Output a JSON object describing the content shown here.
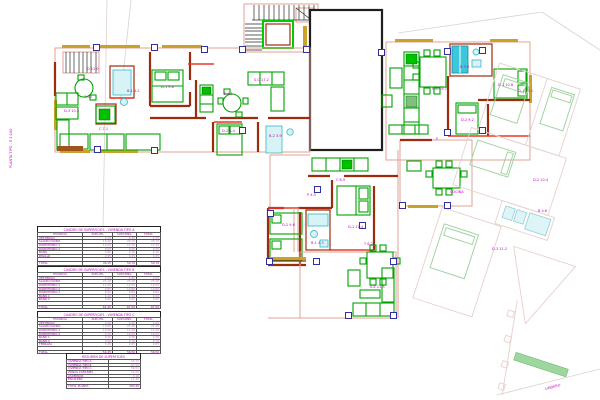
{
  "plan": {
    "side_note": "PLANTA TIPO - E 1:100",
    "boundary_note": "LINDERO",
    "labels": [
      [
        84,
        96,
        "3.60"
      ],
      [
        127,
        90,
        "B-1 4.2"
      ],
      [
        161,
        86,
        "D-1 9.8"
      ],
      [
        224,
        93,
        "E 4.1"
      ],
      [
        254,
        79,
        "S-C 17.2"
      ],
      [
        222,
        130,
        "D-2 8.4"
      ],
      [
        269,
        135,
        "B-2 3.9"
      ],
      [
        64,
        110,
        "D-3 10.2"
      ],
      [
        99,
        128,
        "C 7.1"
      ],
      [
        87,
        68,
        "D 11.0"
      ],
      [
        336,
        179,
        "C 8.9"
      ],
      [
        348,
        226,
        "D-1 11.4"
      ],
      [
        311,
        242,
        "B-1 4.3"
      ],
      [
        282,
        224,
        "D-2 9.6"
      ],
      [
        370,
        286,
        "S-E 21.3"
      ],
      [
        307,
        194,
        "P 4.0"
      ],
      [
        364,
        243,
        "T 6.2"
      ],
      [
        432,
        88,
        "S-C 19.7"
      ],
      [
        460,
        66,
        "B 3.9"
      ],
      [
        498,
        84,
        "D-1 10.8"
      ],
      [
        461,
        119,
        "D-2 9.2"
      ],
      [
        450,
        191,
        "COCINA"
      ],
      [
        436,
        138,
        "E"
      ],
      [
        518,
        90,
        "D-1 10.1"
      ],
      [
        533,
        179,
        "D-2 10.4"
      ],
      [
        538,
        210,
        "B 4.6"
      ],
      [
        492,
        248,
        "D-3 11.2"
      ],
      [
        545,
        388,
        "LINDERO",
        -14
      ],
      [
        10,
        168,
        "PLANTA TIPO - E 1:100",
        -90
      ]
    ],
    "markers": [
      [
        97,
        48
      ],
      [
        155,
        48
      ],
      [
        205,
        50
      ],
      [
        243,
        50
      ],
      [
        307,
        50
      ],
      [
        382,
        53
      ],
      [
        448,
        52
      ],
      [
        483,
        51
      ],
      [
        98,
        150
      ],
      [
        155,
        151
      ],
      [
        243,
        131
      ],
      [
        271,
        214
      ],
      [
        318,
        190
      ],
      [
        363,
        226
      ],
      [
        270,
        262
      ],
      [
        317,
        262
      ],
      [
        394,
        262
      ],
      [
        349,
        316
      ],
      [
        394,
        316
      ],
      [
        448,
        133
      ],
      [
        483,
        131
      ],
      [
        403,
        206
      ],
      [
        448,
        206
      ]
    ]
  },
  "tables": [
    {
      "title": "CUADRO DE SUPERFICIES - VIVIENDA TIPO A",
      "headers": [
        "ESTANCIA",
        "SUP.UTIL",
        "SUP.CONS.",
        "TOTAL"
      ],
      "rows": [
        [
          "VESTIBULO",
          "2.10",
          "2.35",
          "2.35"
        ],
        [
          "SALON-COCINA",
          "18.40",
          "20.15",
          "20.15"
        ],
        [
          "DORMITORIO 1",
          "10.25",
          "11.30",
          "11.30"
        ],
        [
          "DORMITORIO 2",
          "8.60",
          "9.45",
          "9.45"
        ],
        [
          "BAÑO",
          "3.85",
          "4.20",
          "4.20"
        ],
        [
          "PASILLO",
          "2.95",
          "3.25",
          "3.25"
        ]
      ],
      "total": [
        "TOTAL",
        "46.15",
        "50.70",
        "50.70"
      ]
    },
    {
      "title": "CUADRO DE SUPERFICIES - VIVIENDA TIPO B",
      "headers": [
        "ESTANCIA",
        "SUP.UTIL",
        "SUP.CONS.",
        "TOTAL"
      ],
      "rows": [
        [
          "VESTIBULO",
          "2.40",
          "2.60",
          "2.60"
        ],
        [
          "SALON-COCINA",
          "21.15",
          "23.30",
          "23.30"
        ],
        [
          "DORMITORIO 1",
          "11.40",
          "12.55",
          "12.55"
        ],
        [
          "DORMITORIO 2",
          "9.85",
          "10.80",
          "10.80"
        ],
        [
          "DORMITORIO 3",
          "8.95",
          "9.80",
          "9.80"
        ],
        [
          "BAÑO 1",
          "4.10",
          "4.50",
          "4.50"
        ],
        [
          "BAÑO 2",
          "3.60",
          "3.95",
          "3.95"
        ]
      ],
      "total": [
        "TOTAL",
        "61.45",
        "67.50",
        "67.50"
      ]
    },
    {
      "title": "CUADRO DE SUPERFICIES - VIVIENDA TIPO C",
      "headers": [
        "ESTANCIA",
        "SUP.UTIL",
        "SUP.CONS.",
        "TOTAL"
      ],
      "rows": [
        [
          "VESTIBULO",
          "2.20",
          "2.40",
          "2.40"
        ],
        [
          "SALON-COCINA",
          "19.60",
          "21.45",
          "21.45"
        ],
        [
          "DORMITORIO 1",
          "10.90",
          "11.95",
          "11.95"
        ],
        [
          "DORMITORIO 2",
          "9.15",
          "10.05",
          "10.05"
        ],
        [
          "BAÑO 1",
          "3.95",
          "4.30",
          "4.30"
        ],
        [
          "BAÑO 2",
          "3.40",
          "3.70",
          "3.70"
        ],
        [
          "TERRAZA",
          "5.25",
          "2.65",
          "2.65"
        ]
      ],
      "total": [
        "TOTAL",
        "54.45",
        "56.50",
        "56.50"
      ]
    },
    {
      "title": "RESUMEN DE SUPERFICIES",
      "headers": null,
      "rows": [
        [
          "VIVIENDA TIPO A",
          "50.70"
        ],
        [
          "VIVIENDA TIPO B",
          "67.50"
        ],
        [
          "VIVIENDA TIPO C",
          "56.50"
        ],
        [
          "ZONAS COMUNES",
          "14.25"
        ],
        [
          "ASCENSOR",
          "3.10"
        ],
        [
          "ESCALERA",
          "11.40"
        ]
      ],
      "total": [
        "TOTAL PLANTA",
        "203.45"
      ]
    }
  ]
}
